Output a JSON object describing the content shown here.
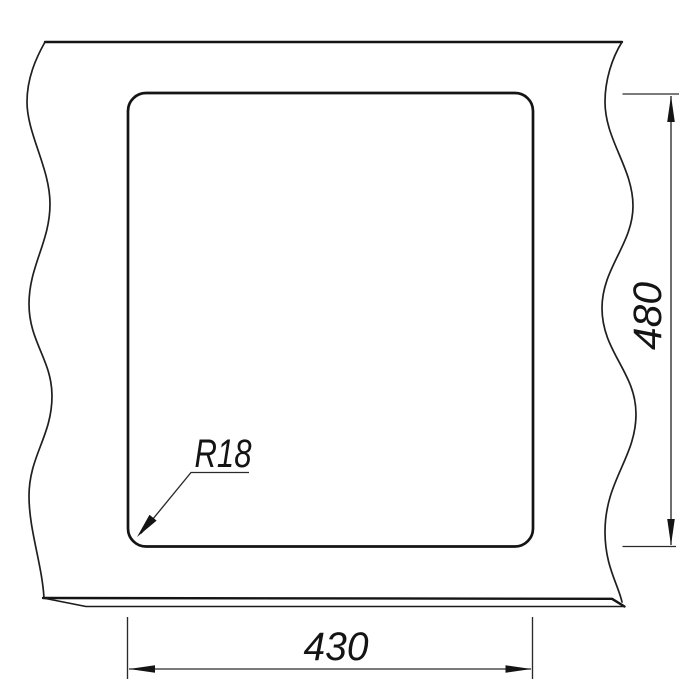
{
  "drawing": {
    "description": "Technical cutout drawing of a panel with break lines and a rounded-corner rectangular opening",
    "labels": {
      "height_dim": "480",
      "width_dim": "430",
      "corner_radius": "R18"
    },
    "colors": {
      "line": "#141414",
      "background": "#ffffff"
    }
  }
}
